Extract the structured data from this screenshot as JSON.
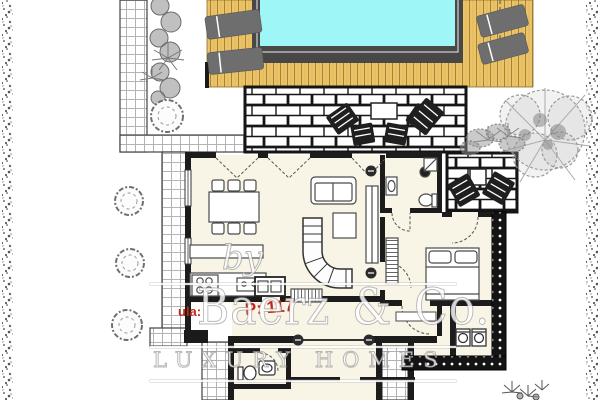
{
  "watermark": {
    "prefix": "by",
    "brand": "Baerz & Co.",
    "tagline": "LUXURY HOMES"
  },
  "annotations": {
    "label_fragment": "ula:",
    "area_fragment": "P: 117"
  },
  "palette": {
    "pool_water": "#9ef6f6",
    "pool_edge": "#484848",
    "deck_wood": "#ecc467",
    "deck_plank_line": "#a3823a",
    "lounger_gray": "#6e6e6e",
    "plan_line": "#1c1c1c",
    "interior_floor": "#f8f4e6",
    "annotation_red": "#c0281e",
    "watermark_white": "rgba(255,255,255,0.82)"
  },
  "plan_features": [
    "swimming-pool",
    "wood-deck",
    "sun-loungers",
    "brick-terrace",
    "outdoor-dining-set",
    "guest-patio",
    "garden-tree",
    "hedge-bushes",
    "tiled-walkways",
    "property-boundary",
    "living-dining-room",
    "kitchen",
    "staircase",
    "bathroom",
    "bedroom",
    "laundry",
    "wc"
  ]
}
